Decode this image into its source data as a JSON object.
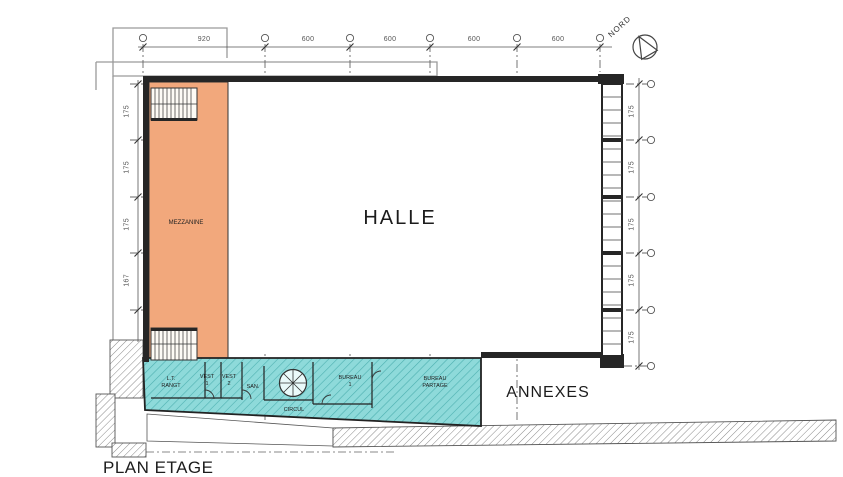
{
  "title": "PLAN ETAGE",
  "north": {
    "label": "NORD"
  },
  "rooms": {
    "halle": "HALLE",
    "mezzanine": "MEZZANINE",
    "annexes": "ANNEXES",
    "lt_rangt": "L.T.\nRANGT",
    "vest_1": "VEST\n1",
    "vest_2": "VEST\n2",
    "san": "SAN.",
    "bureau_1": "BUREAU\n1",
    "bureau_partage": "BUREAU\nPARTAGE",
    "circul": "CIRCUL"
  },
  "dims": {
    "top": [
      "920",
      "600",
      "600",
      "600",
      "600"
    ],
    "left": [
      "175",
      "175",
      "175",
      "167"
    ],
    "right": [
      "175",
      "175",
      "175",
      "175",
      "175"
    ]
  },
  "colors": {
    "mezzanine_fill": "#f2a87c",
    "annexes_fill": "#8edada",
    "wall": "#262626"
  },
  "icons": {
    "north_arrow": "compass-north-arrow",
    "stairs": "stair-treads",
    "spiral_stair": "spiral-staircase"
  }
}
